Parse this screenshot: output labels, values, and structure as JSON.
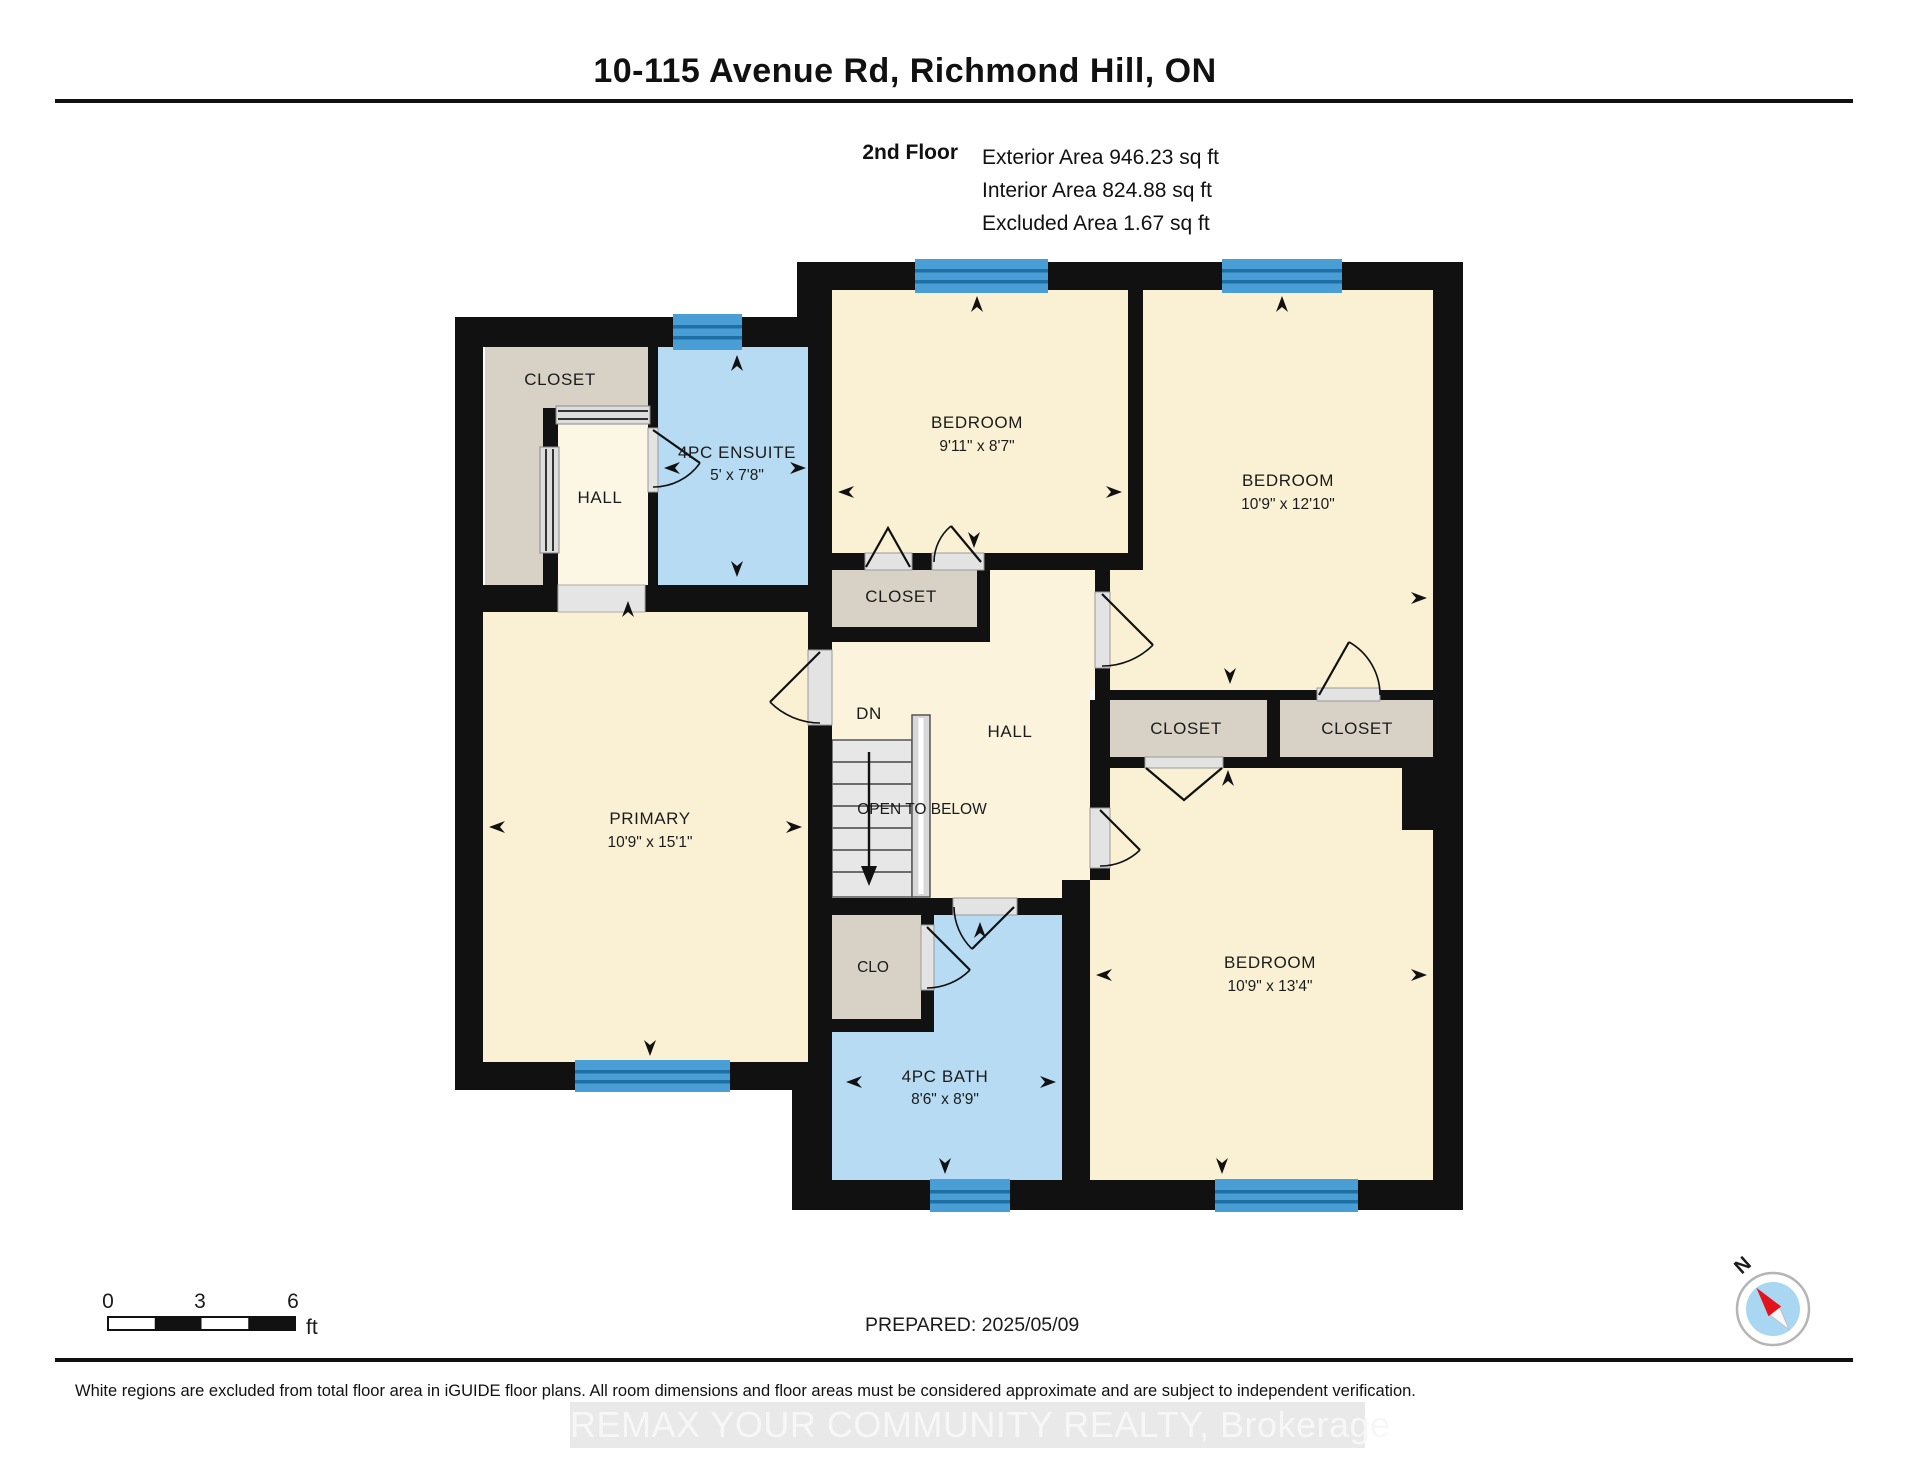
{
  "header": {
    "title": "10-115 Avenue Rd, Richmond Hill, ON",
    "floor_label": "2nd Floor",
    "exterior_area": "Exterior Area 946.23 sq ft",
    "interior_area": "Interior Area 824.88 sq ft",
    "excluded_area": "Excluded Area 1.67 sq ft"
  },
  "rooms": {
    "closet_main": {
      "label": "CLOSET"
    },
    "hall_small": {
      "label": "HALL"
    },
    "ensuite": {
      "label": "4PC ENSUITE",
      "dims": "5' x 7'8\""
    },
    "bedroom_top": {
      "label": "BEDROOM",
      "dims": "9'11\" x 8'7\""
    },
    "bedroom_right": {
      "label": "BEDROOM",
      "dims": "10'9\" x 12'10\""
    },
    "closet_center": {
      "label": "CLOSET"
    },
    "hall_center": {
      "label": "HALL"
    },
    "stairs": {
      "down_label": "DN",
      "open_label": "OPEN TO BELOW"
    },
    "primary": {
      "label": "PRIMARY",
      "dims": "10'9\" x 15'1\""
    },
    "closet_row_left": {
      "label": "CLOSET"
    },
    "closet_row_right": {
      "label": "CLOSET"
    },
    "clo": {
      "label": "CLO"
    },
    "bath": {
      "label": "4PC BATH",
      "dims": "8'6\" x 8'9\""
    },
    "bedroom_bottom": {
      "label": "BEDROOM",
      "dims": "10'9\" x 13'4\""
    }
  },
  "scale_bar": {
    "t0": "0",
    "t3": "3",
    "t6": "6",
    "unit": "ft"
  },
  "prepared_label": "PREPARED: 2025/05/09",
  "compass": {
    "north": "N"
  },
  "footer": {
    "disclaimer": "White regions are excluded from total floor area in iGUIDE floor plans. All room dimensions and floor areas must be considered approximate and are subject to independent verification.",
    "watermark": "REMAX YOUR COMMUNITY REALTY, Brokerage"
  },
  "colors": {
    "room": "#FAF1D4",
    "hall": "#FCF7E5",
    "closet": "#D8D1C5",
    "wet_room": "#B6DBF2",
    "window": "#4A9ED6",
    "window_stripe": "#1E6FA4",
    "wall": "#111111"
  }
}
